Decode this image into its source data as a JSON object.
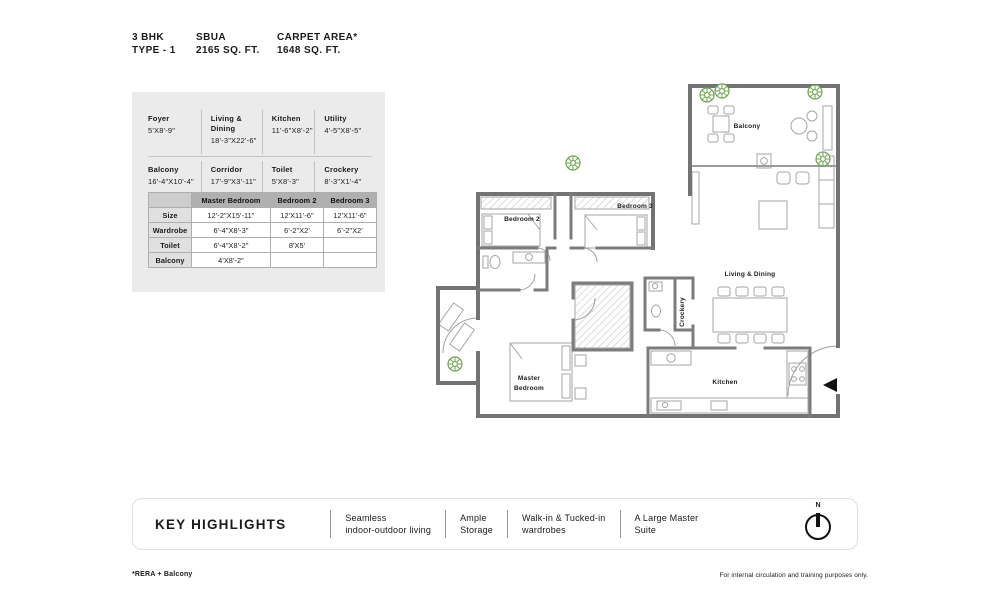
{
  "header": {
    "bhk": "3 BHK",
    "type": "TYPE - 1",
    "sbua_label": "SBUA",
    "sbua_value": "2165 SQ. FT.",
    "carpet_label": "CARPET AREA*",
    "carpet_value": "1648 SQ. FT."
  },
  "dimensions": {
    "rows": [
      [
        {
          "name": "Foyer",
          "size": "5'X8'-9\""
        },
        {
          "name": "Living & Dining",
          "size": "18'-3\"X22'-6\""
        },
        {
          "name": "Kitchen",
          "size": "11'-6\"X8'-2\""
        },
        {
          "name": "Utility",
          "size": "4'-5\"X8'-5\""
        }
      ],
      [
        {
          "name": "Balcony",
          "size": "16'-4\"X10'-4\""
        },
        {
          "name": "Corridor",
          "size": "17'-9\"X3'-11\""
        },
        {
          "name": "Toilet",
          "size": "5'X8'-3\""
        },
        {
          "name": "Crockery",
          "size": "8'-3\"X1'-4\""
        }
      ]
    ]
  },
  "bedroom_table": {
    "headers": [
      "",
      "Master Bedroom",
      "Bedroom 2",
      "Bedroom 3"
    ],
    "rows": [
      {
        "label": "Size",
        "cells": [
          "12'-2\"X15'-11\"",
          "12'X11'-6\"",
          "12'X11'-6\""
        ]
      },
      {
        "label": "Wardrobe",
        "cells": [
          "6'-4\"X8'-3\"",
          "6'-2\"X2'",
          "6'-2\"X2'"
        ]
      },
      {
        "label": "Toilet",
        "cells": [
          "6'-4\"X8'-2\"",
          "8'X5'",
          ""
        ]
      },
      {
        "label": "Balcony",
        "cells": [
          "4'X8'-2\"",
          "",
          ""
        ]
      }
    ]
  },
  "floorplan": {
    "labels": {
      "balcony": "Balcony",
      "bedroom2": "Bedroom 2",
      "bedroom3": "Bedroom 3",
      "living_dining": "Living & Dining",
      "crockery": "Crockery",
      "master_line1": "Master",
      "master_line2": "Bedroom",
      "kitchen": "Kitchen"
    }
  },
  "highlights": {
    "title": "KEY HIGHLIGHTS",
    "items": [
      {
        "line1": "Seamless",
        "line2": "indoor-outdoor living"
      },
      {
        "line1": "Ample",
        "line2": "Storage"
      },
      {
        "line1": "Walk-in & Tucked-in",
        "line2": "wardrobes"
      },
      {
        "line1": "A Large Master",
        "line2": "Suite"
      }
    ],
    "compass_n": "N"
  },
  "footer": {
    "left": "*RERA + Balcony",
    "right": "For internal circulation and training purposes only."
  },
  "colors": {
    "panel_bg": "#ebebeb",
    "table_header_bg": "#b0b0b0",
    "wall_gray": "#737373",
    "plant_green": "#6fa352",
    "text": "#1a1a1a"
  }
}
